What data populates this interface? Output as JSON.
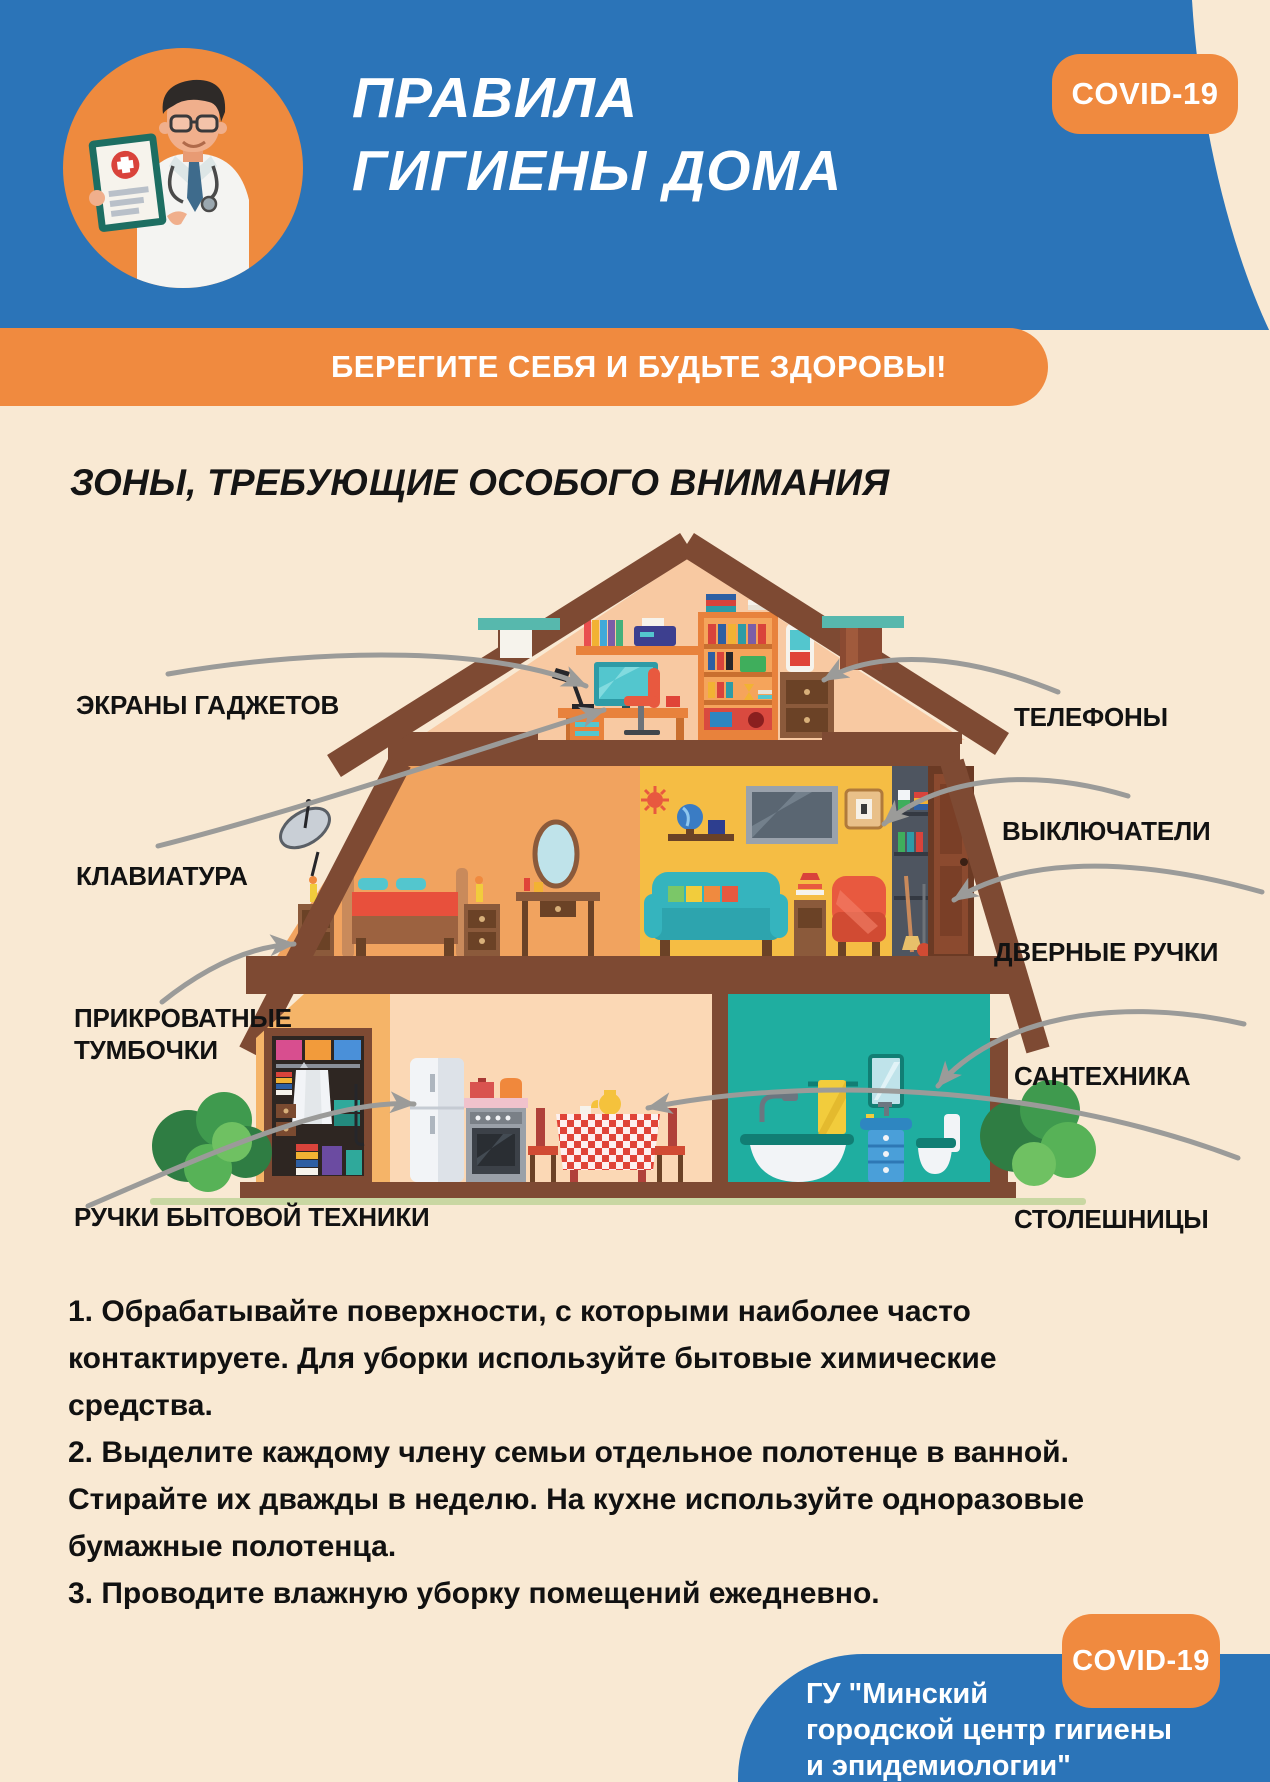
{
  "poster": {
    "header": {
      "title": "ПРАВИЛА\nГИГИЕНЫ ДОМА",
      "covid_badge": "COVID-19"
    },
    "banner": {
      "text": "БЕРЕГИТЕ СЕБЯ И БУДЬТЕ ЗДОРОВЫ!"
    },
    "section_heading": "ЗОНЫ, ТРЕБУЮЩИЕ ОСОБОГО ВНИМАНИЯ",
    "zones": {
      "left": [
        {
          "id": "screens",
          "text": "ЭКРАНЫ ГАДЖЕТОВ"
        },
        {
          "id": "keyboard",
          "text": "КЛАВИАТУРА"
        },
        {
          "id": "nightstands",
          "text": "ПРИКРОВАТНЫЕ\nТУМБОЧКИ"
        },
        {
          "id": "appliance-handles",
          "text": "РУЧКИ БЫТОВОЙ ТЕХНИКИ"
        }
      ],
      "right": [
        {
          "id": "phones",
          "text": "ТЕЛЕФОНЫ"
        },
        {
          "id": "switches",
          "text": "ВЫКЛЮЧАТЕЛИ"
        },
        {
          "id": "door-handles",
          "text": "ДВЕРНЫЕ РУЧКИ"
        },
        {
          "id": "plumbing",
          "text": "САНТЕХНИКА"
        },
        {
          "id": "countertops",
          "text": "СТОЛЕШНИЦЫ"
        }
      ]
    },
    "tips": [
      "1. Обрабатывайте поверхности, с которыми наиболее часто\nконтактируете. Для уборки используйте бытовые химические\nсредства.",
      "2. Выделите каждому члену семьи отдельное полотенце в ванной.\nСтирайте их дважды в неделю. На кухне используйте одноразовые\nбумажные полотенца.",
      "3. Проводите влажную уборку помещений ежедневно."
    ],
    "footer": {
      "covid_badge": "COVID-19",
      "organization": "ГУ \"Минский\nгородской центр гигиены\nи эпидемиологии\""
    },
    "palette": {
      "header_blue": "#2B74B8",
      "accent_orange": "#F08A3F",
      "background_cream": "#F9E9D3",
      "roof_brown": "#7E4A33",
      "attic_peach": "#F8C9A2",
      "bedroom_orange": "#F1A35F",
      "living_yellow": "#F5BD44",
      "kitchen_cream": "#FBD8B5",
      "bathroom_teal": "#1FAEA0",
      "arrow_grey": "#9B9B99"
    }
  }
}
